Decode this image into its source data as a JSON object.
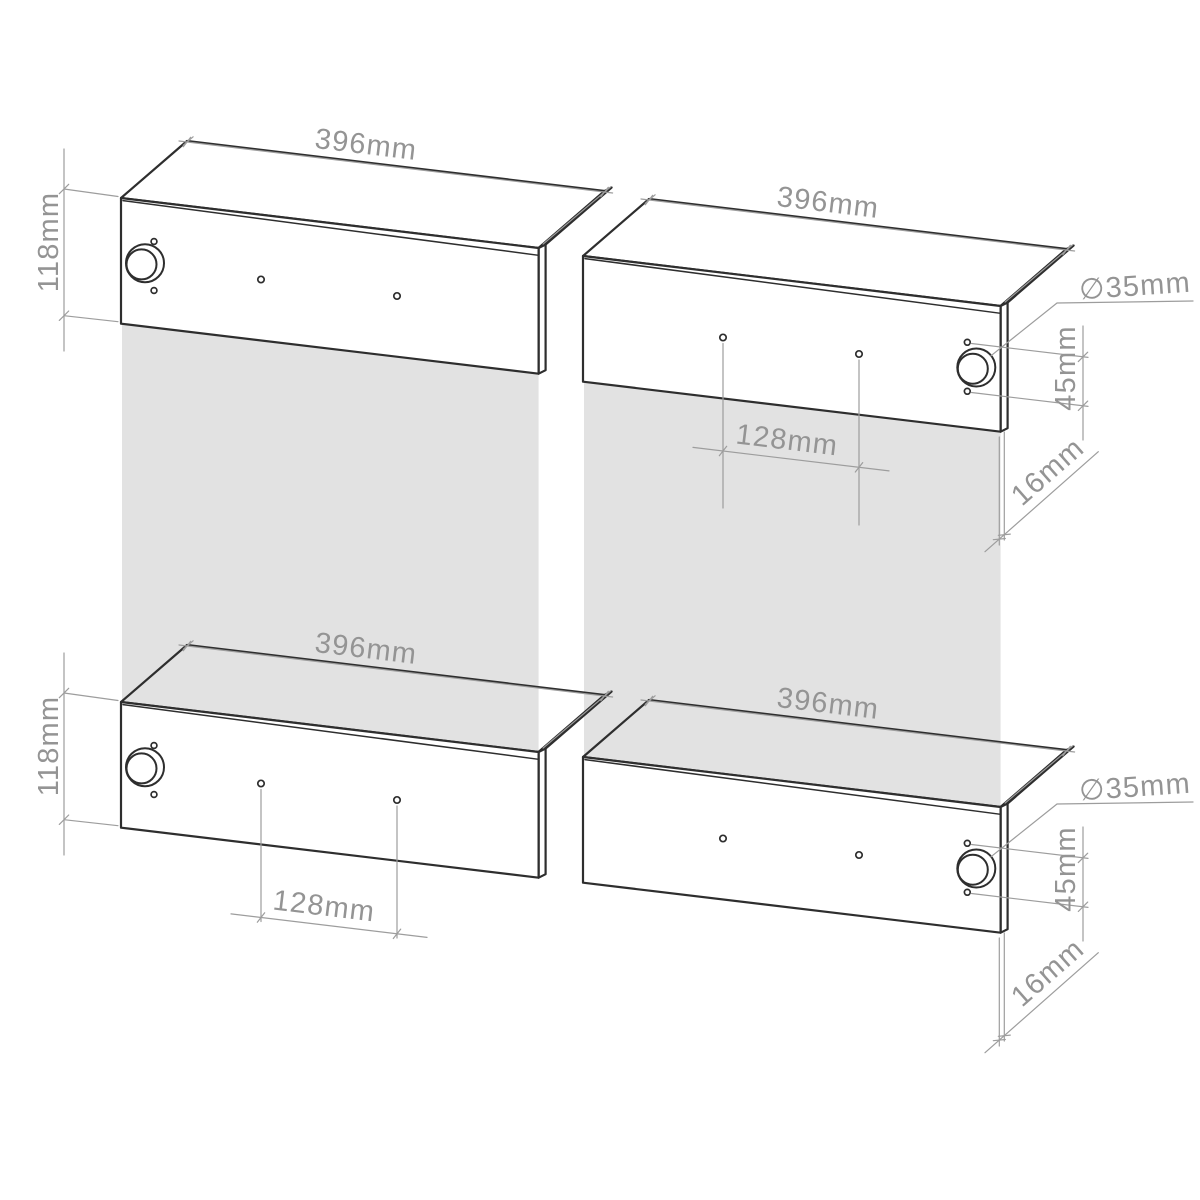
{
  "drawing": {
    "type": "furniture-drilling-diagram",
    "panels": [
      {
        "id": "top-left",
        "hinge_cup_side": "left"
      },
      {
        "id": "top-right",
        "hinge_cup_side": "right"
      },
      {
        "id": "bottom-left",
        "hinge_cup_side": "left"
      },
      {
        "id": "bottom-right",
        "hinge_cup_side": "right"
      }
    ]
  },
  "labels": {
    "width_tl": "396mm",
    "width_tr": "396mm",
    "width_bl": "396mm",
    "width_br": "396mm",
    "height_tl": "118mm",
    "height_bl": "118mm",
    "spacing_tr": "128mm",
    "spacing_bl": "128mm",
    "diameter_tr": "∅35mm",
    "diameter_br": "∅35mm",
    "screw_spacing_tr": "45mm",
    "screw_spacing_br": "45mm",
    "thickness_tr": "16mm",
    "thickness_br": "16mm"
  },
  "colors": {
    "background": "#ffffff",
    "outline": "#2e2e2e",
    "dimension_line": "#9d9d9d",
    "dimension_text": "#949494",
    "shadow": "#e2e2e2"
  }
}
